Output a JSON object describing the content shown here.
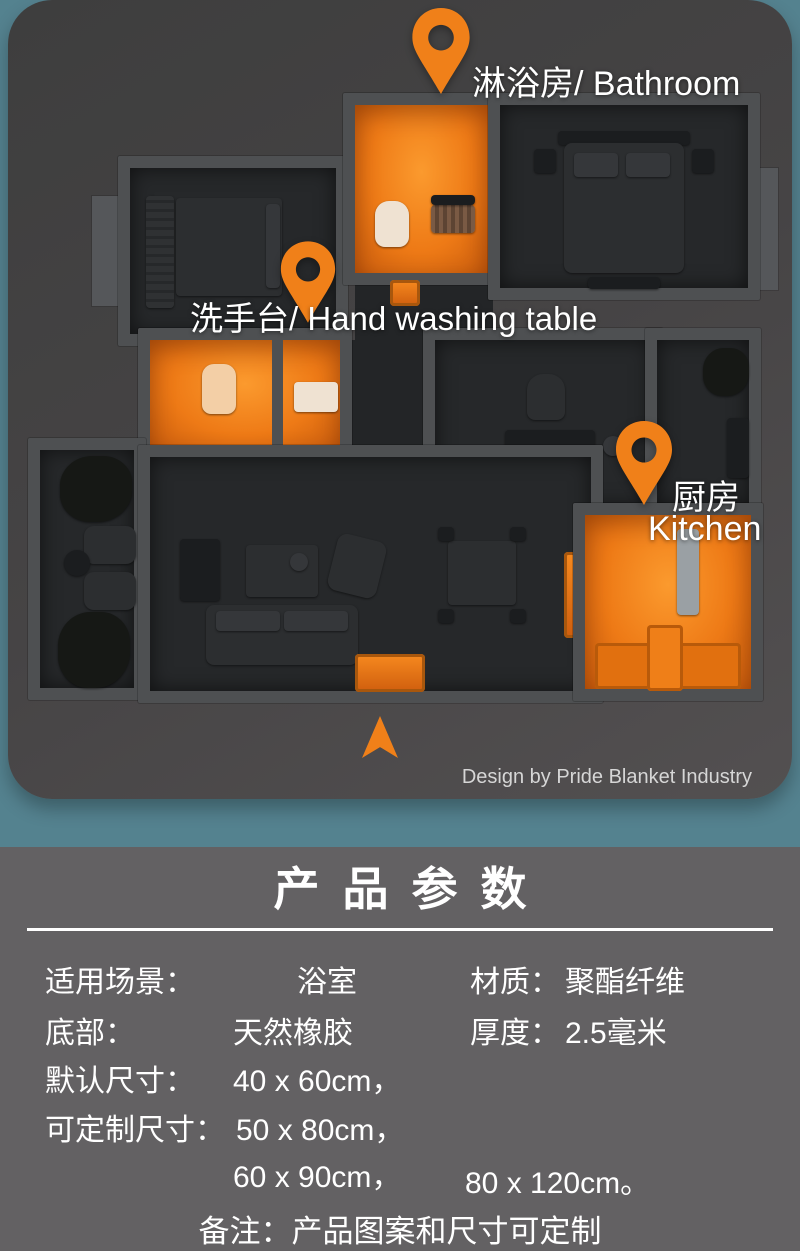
{
  "hero": {
    "pins": {
      "bathroom": {
        "label": "淋浴房/ Bathroom"
      },
      "hand_washing": {
        "label": "洗手台/ Hand washing table"
      },
      "kitchen": {
        "label_zh": "厨房",
        "label_en": "Kitchen"
      }
    },
    "credit": "Design by Pride Blanket Industry"
  },
  "specs": {
    "title": "产品参数",
    "rows": {
      "left": [
        {
          "label": "适用场景：",
          "value": "浴室"
        },
        {
          "label": "底部：",
          "value": "天然橡胶"
        },
        {
          "label": "默认尺寸：",
          "value": "40 x 60cm，"
        },
        {
          "label": "可定制尺寸：",
          "value": "50 x 80cm，"
        },
        {
          "label": "",
          "value": "60 x 90cm，"
        }
      ],
      "right": [
        {
          "label": "材质：",
          "value": "聚酯纤维"
        },
        {
          "label": "厚度：",
          "value": "2.5毫米"
        },
        {
          "label": "",
          "value": "80 x 120cm。"
        }
      ]
    },
    "note": "备注：产品图案和尺寸可定制"
  },
  "colors": {
    "accent_orange": "#f08019",
    "background_teal": "#54828f",
    "card_gray": "#464445",
    "section_gray": "#636163",
    "wall_gray": "#4e5052",
    "floor_dark": "#26282a",
    "text_white": "#ffffff",
    "credit_gray": "#d6d6d6"
  }
}
